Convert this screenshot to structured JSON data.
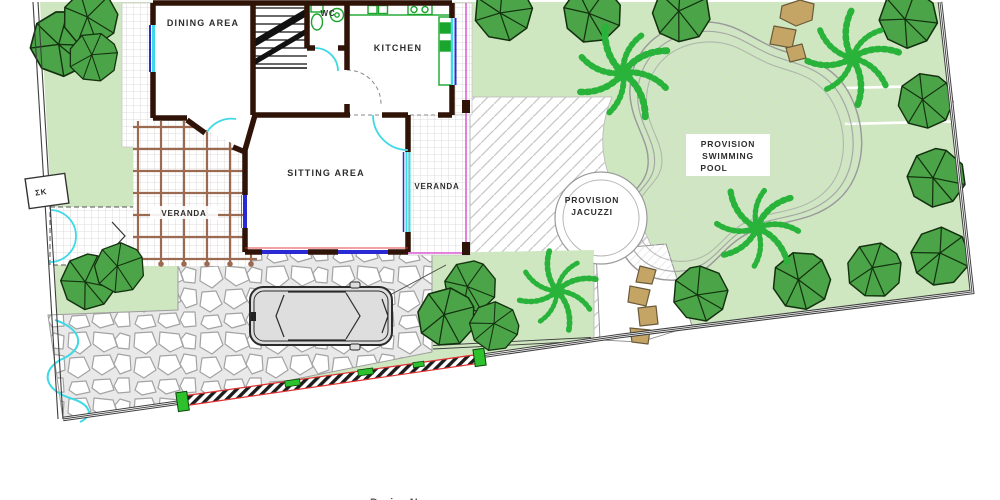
{
  "labels": {
    "dining": "DINING AREA",
    "wc": "WC",
    "kitchen": "KITCHEN",
    "sitting": "SITTING AREA",
    "veranda_left": "VERANDA",
    "veranda_right": "VERANDA",
    "pool_l1": "PROVISION",
    "pool_l2": "SWIMMING",
    "pool_l3": "POOL",
    "jacuzzi_l1": "PROVISION",
    "jacuzzi_l2": "JACUZZI",
    "utility_box": "ΣΚ",
    "bottom_cutoff": "Design No"
  },
  "colors": {
    "lawn": "#cfe7c1",
    "treefill": "#4ca449",
    "treeline": "#13310f",
    "palm": "#29b33b",
    "wall": "#2f1307",
    "pergola": "#9b6a50",
    "cyan": "#3fd9e6",
    "blue": "#2a2ad4",
    "magenta": "#e060d8",
    "red": "#e03030",
    "fixture": "#1aa52c",
    "fencegreen": "#2ec12e",
    "rock": "#c4a566",
    "rockline": "#6b5b3a",
    "text": "#2d2d2d",
    "outline": "#3f3f3f"
  }
}
